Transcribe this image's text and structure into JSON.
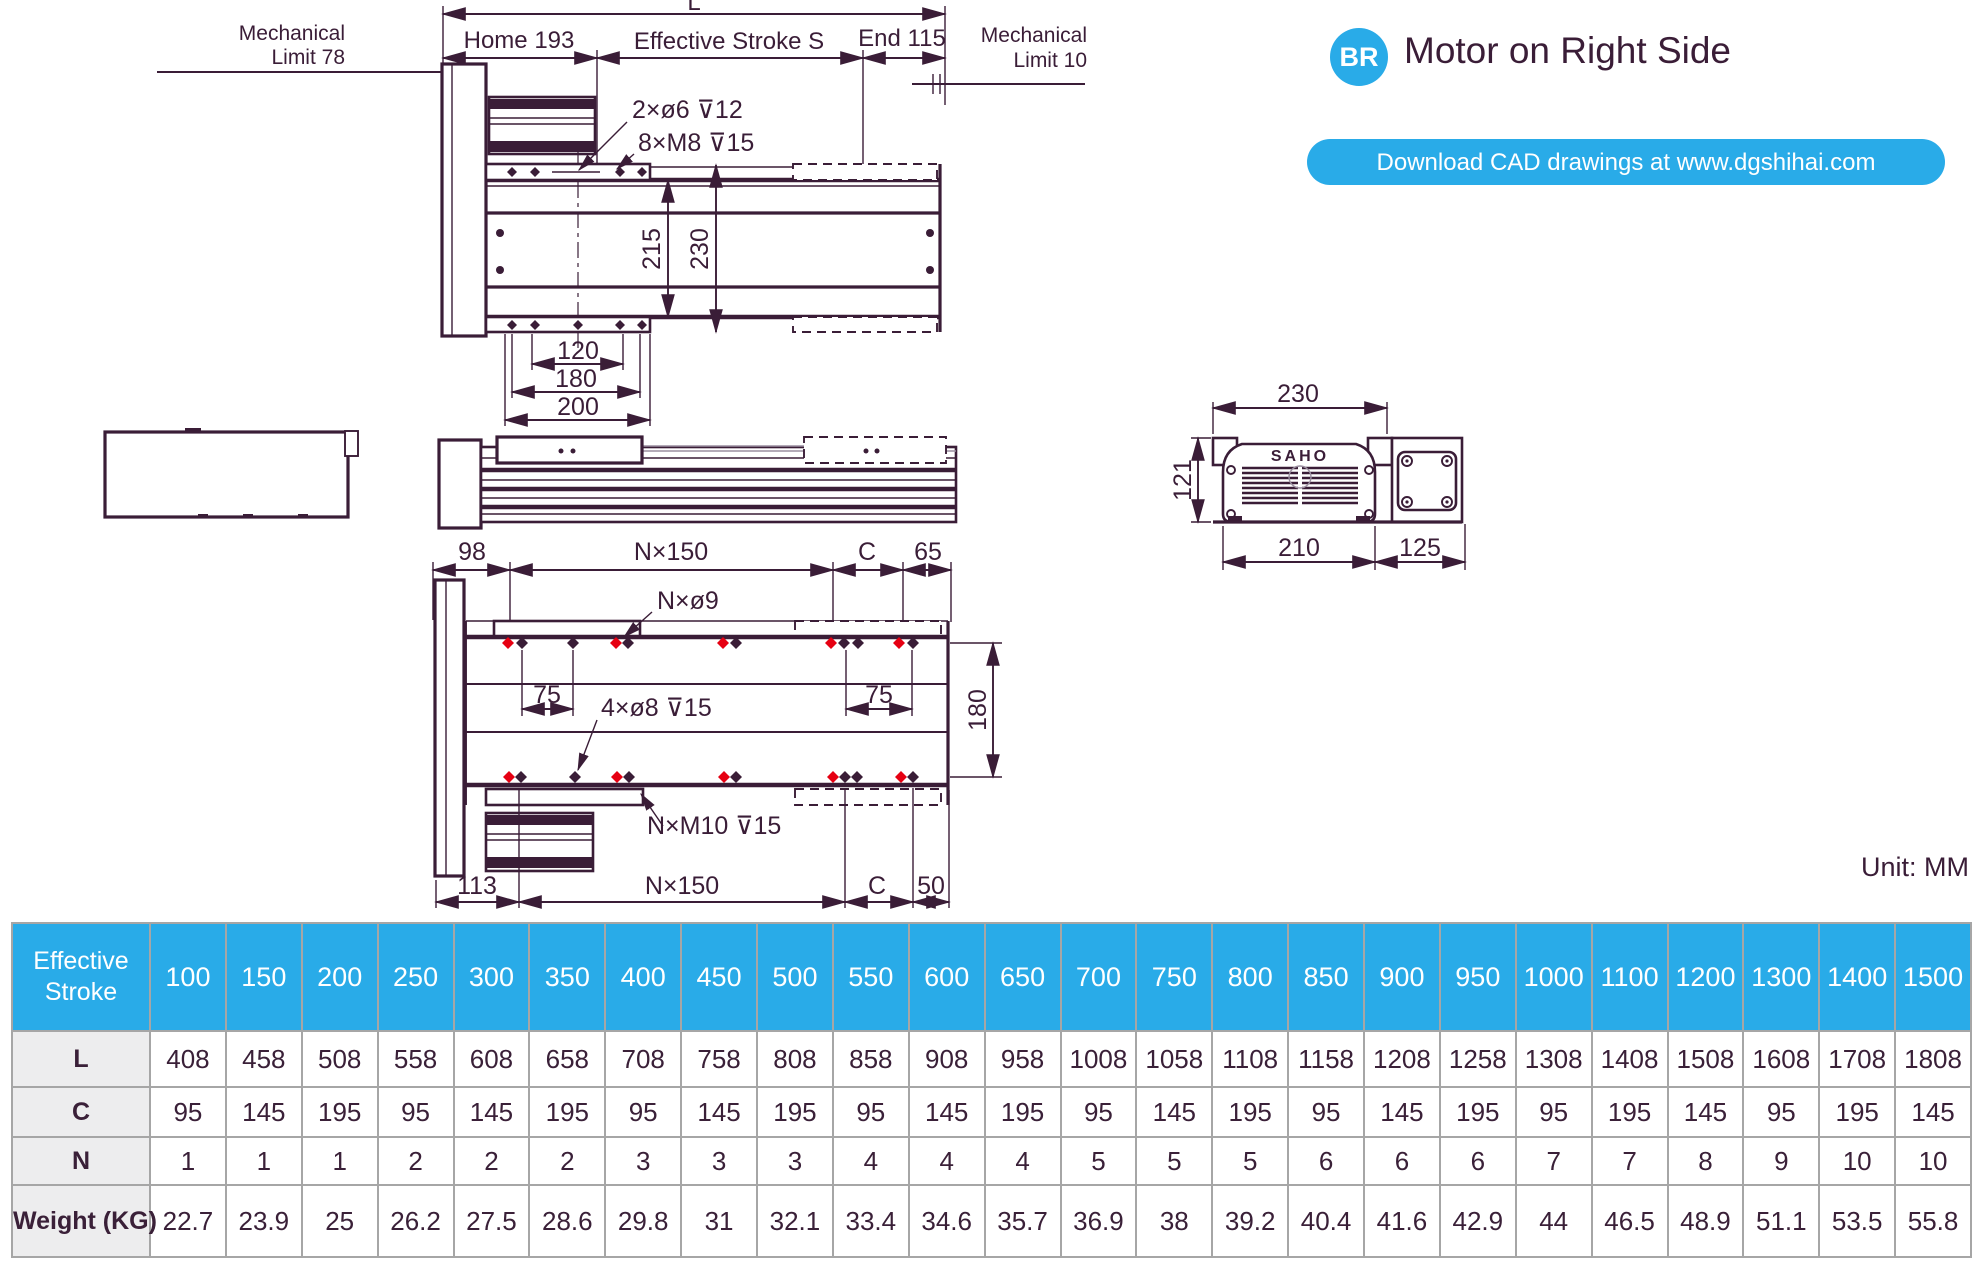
{
  "header": {
    "badge": "BR",
    "title": "Motor on Right Side",
    "button_label": "Download CAD drawings at www.dgshihai.com"
  },
  "unit_label": "Unit: MM",
  "colors": {
    "accent_blue": "#29abe8",
    "line_dark": "#3a1d37",
    "hole_red": "#e60012"
  },
  "drawing": {
    "top": {
      "l": "L",
      "home": "Home 193",
      "stroke": "Effective Stroke S",
      "end": "End 115",
      "mech_left1": "Mechanical",
      "mech_left2": "Limit 78",
      "mech_right1": "Mechanical",
      "mech_right2": "Limit 10",
      "ann1": "2×ø6 ⊽12",
      "ann2": "8×M8 ⊽15",
      "d215": "215",
      "d230": "230",
      "d120": "120",
      "d180": "180",
      "d200": "200"
    },
    "end": {
      "brand": "SAHO",
      "d230": "230",
      "d121": "121",
      "d210": "210",
      "d125": "125"
    },
    "bottom": {
      "d98": "98",
      "n150_top": "N×150",
      "c_top": "C",
      "d65": "65",
      "ann1": "N×ø9",
      "d75_left": "75",
      "d75_right": "75",
      "ann2": "4×ø8 ⊽15",
      "ann3": "N×M10 ⊽15",
      "d180": "180",
      "d113": "113",
      "n150_bottom": "N×150",
      "c_bottom": "C",
      "d50": "50"
    }
  },
  "table": {
    "row_headers": [
      "Effective Stroke",
      "L",
      "C",
      "N",
      "Weight (KG)"
    ],
    "strokes": [
      100,
      150,
      200,
      250,
      300,
      350,
      400,
      450,
      500,
      550,
      600,
      650,
      700,
      750,
      800,
      850,
      900,
      950,
      1000,
      1100,
      1200,
      1300,
      1400,
      1500
    ],
    "l": [
      408,
      458,
      508,
      558,
      608,
      658,
      708,
      758,
      808,
      858,
      908,
      958,
      1008,
      1058,
      1108,
      1158,
      1208,
      1258,
      1308,
      1408,
      1508,
      1608,
      1708,
      1808
    ],
    "c": [
      95,
      145,
      195,
      95,
      145,
      195,
      95,
      145,
      195,
      95,
      145,
      195,
      95,
      145,
      195,
      95,
      145,
      195,
      95,
      195,
      145,
      95,
      195,
      145
    ],
    "n": [
      1,
      1,
      1,
      2,
      2,
      2,
      3,
      3,
      3,
      4,
      4,
      4,
      5,
      5,
      5,
      6,
      6,
      6,
      7,
      7,
      8,
      9,
      10,
      10
    ],
    "weight": [
      22.7,
      23.9,
      25,
      26.2,
      27.5,
      28.6,
      29.8,
      31,
      32.1,
      33.4,
      34.6,
      35.7,
      36.9,
      38,
      39.2,
      40.4,
      41.6,
      42.9,
      44,
      46.5,
      48.9,
      51.1,
      53.5,
      55.8
    ]
  }
}
